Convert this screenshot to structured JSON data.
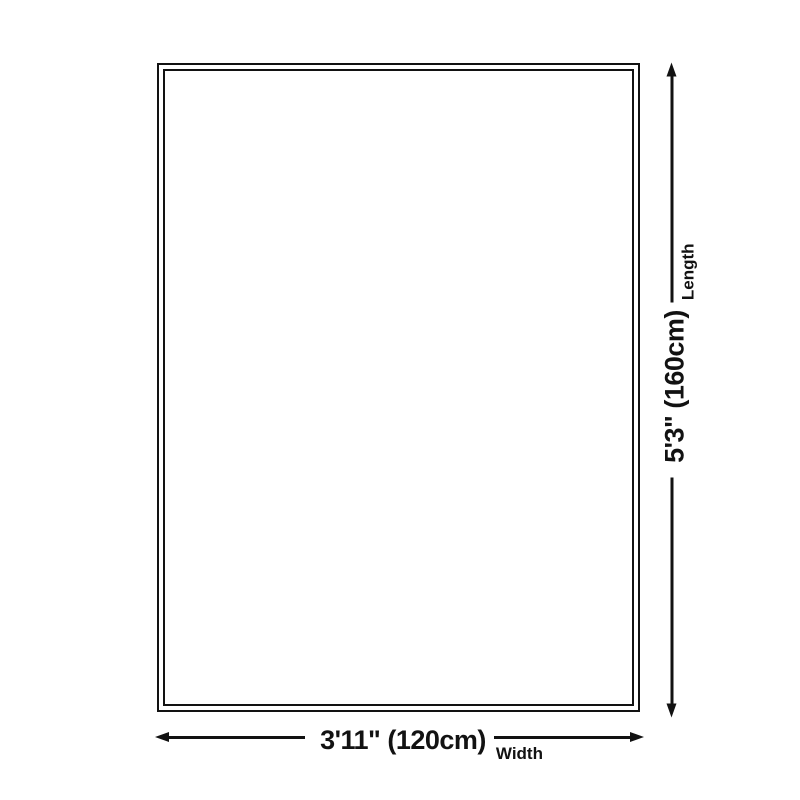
{
  "page": {
    "background_color": "#ffffff",
    "ink_color": "#121212",
    "description": "Product size diagram of a rectangular rug with double border and dimension arrows"
  },
  "dimensions": {
    "width": {
      "value": "3'11\" (120cm)",
      "label": "Width"
    },
    "length": {
      "value": "5'3\" (160cm)",
      "label": "Length"
    }
  }
}
